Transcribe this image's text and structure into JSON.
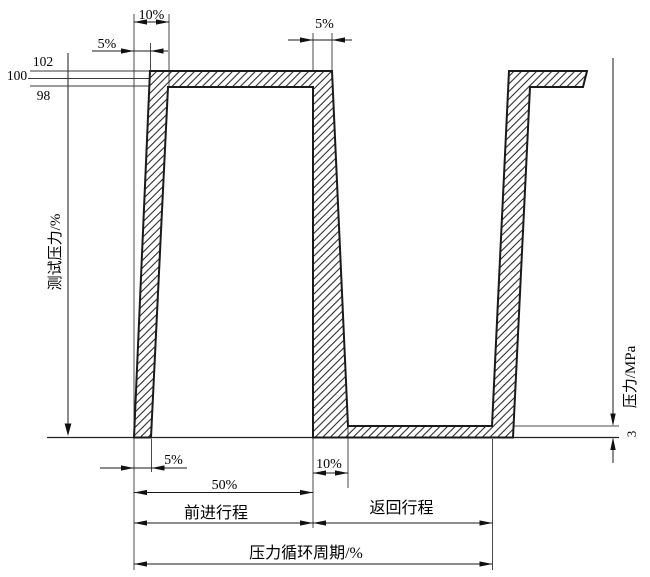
{
  "axes": {
    "left": {
      "label": "测试压力/%",
      "ticks": [
        {
          "value": "102"
        },
        {
          "value": "100"
        },
        {
          "value": "98"
        }
      ]
    },
    "right": {
      "label": "压力/MPa",
      "tick": "3"
    }
  },
  "dims": {
    "top_rise_total": "10%",
    "top_rise_start": "5%",
    "top_fall": "5%",
    "bottom_start": "5%",
    "bottom_fall": "10%",
    "half_cycle": "50%",
    "forward_stroke": "前进行程",
    "return_stroke": "返回行程",
    "cycle_period": "压力循环周期/%"
  },
  "waveform": {
    "test_pressure_upper_percent": "102",
    "test_pressure_nominal_percent": "100",
    "test_pressure_lower_percent": "98",
    "return_level_pressure_mpa": "3",
    "band_style": "diagonal-hatch"
  },
  "colors": {
    "outline": "#1a1a1a",
    "extension_line": "#4b4b4b",
    "background": "#ffffff"
  }
}
